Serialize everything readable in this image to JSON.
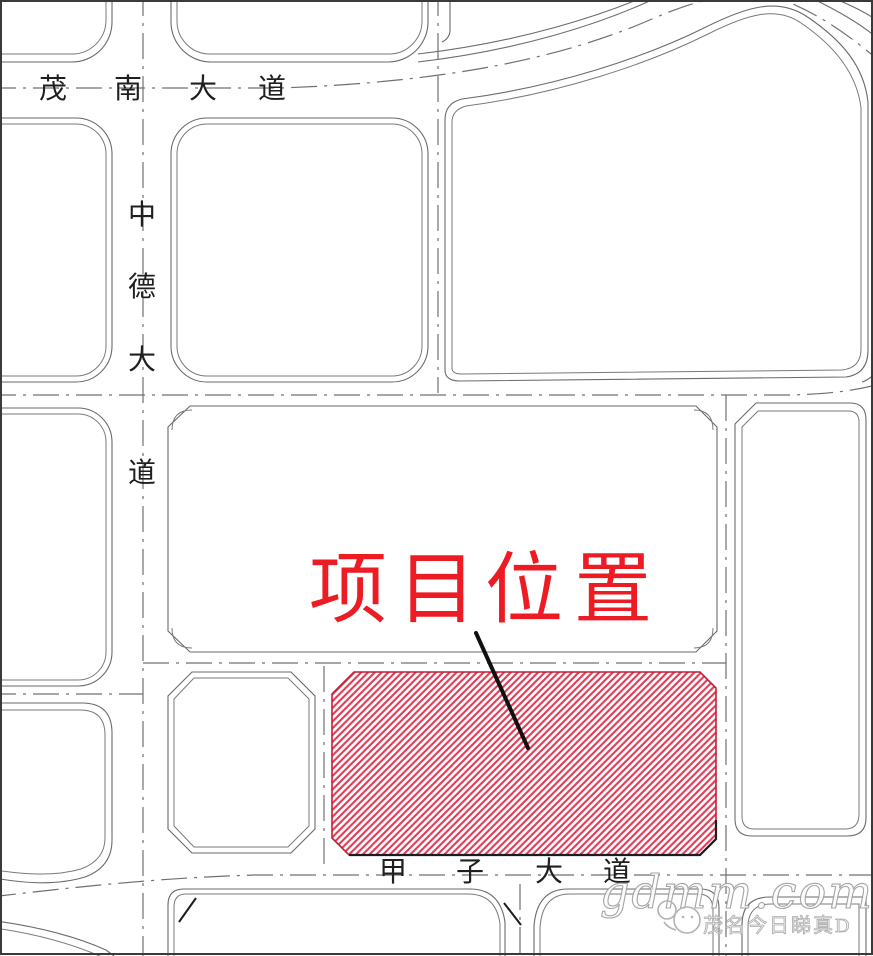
{
  "figure": {
    "kind": "project-site-location-map",
    "canvas": {
      "width": 873,
      "height": 956
    }
  },
  "title": {
    "text": "项目位置",
    "chars": [
      "项",
      "目",
      "位",
      "置"
    ],
    "color": "#ed1c24"
  },
  "roads": {
    "maonan": {
      "name": "茂南大道",
      "chars": [
        "茂",
        "南",
        "大",
        "道"
      ],
      "orientation": "horizontal-top"
    },
    "zhongde": {
      "name": "中德大道",
      "chars": [
        "中",
        "德",
        "大",
        "道"
      ],
      "orientation": "vertical-left"
    },
    "jiazi": {
      "name": "甲子大道",
      "chars": [
        "甲",
        "子",
        "大",
        "道"
      ],
      "orientation": "horizontal-bottom"
    }
  },
  "site": {
    "label": "项目位置",
    "hatch_color": "#e03a55",
    "outline_color": "#c41f33"
  },
  "watermark": {
    "brand": "gdmm.com",
    "account": "茂名今日睇真D"
  },
  "colors": {
    "block_line": "#6a6a6a",
    "centerline": "#707070",
    "road_label": "#1f1f1f",
    "title_red": "#ed1c24",
    "hatch_red": "#e03a55",
    "site_outline_red": "#c41f33",
    "leader_black": "#1c1c1c",
    "watermark_gray": "#9e9e9e"
  }
}
